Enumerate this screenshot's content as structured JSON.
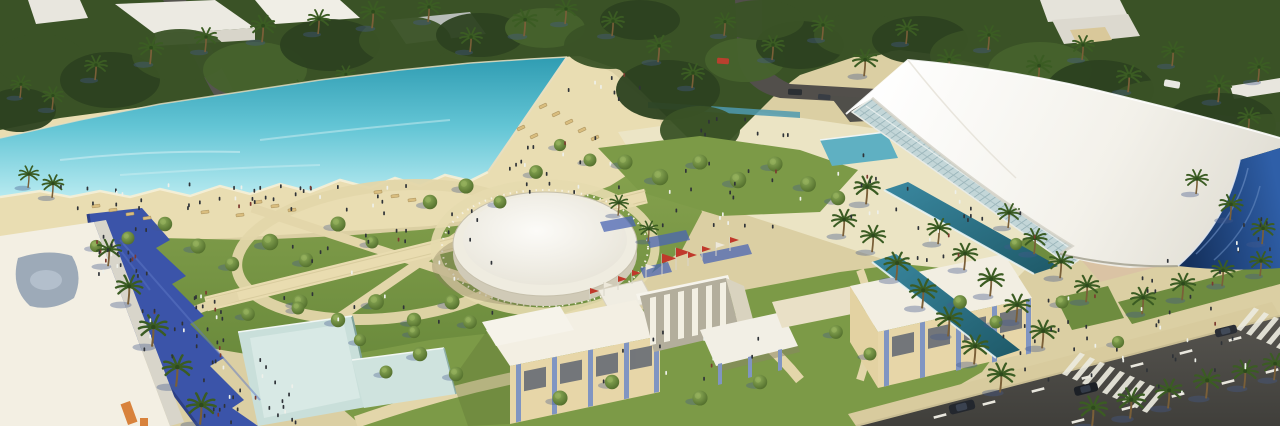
{
  "meta": {
    "type": "architectural-aerial-rendering",
    "description": "Aerial rendering of a coastal leisure park: turquoise lagoon pool with beach, landscaped gardens with paths, circular white pavilion, cream entrance buildings with red flags, sweeping white tensile canopy with glass facade and navy glass sail, palm-lined plazas, reflecting pools, blue shaded promenade and perimeter roads with crosswalks and cars.",
    "width": 1280,
    "height": 426
  },
  "palette": {
    "sand_base": "#dbcfa3",
    "beach": "#e9ddb2",
    "plaza": "#ece5c8",
    "sidewalk": "#d8cb9e",
    "canopy_green": "#3a5226",
    "grass": "#7c9a47",
    "grass_dark": "#6e8c3f",
    "water_deep": "#2f9cb2",
    "water_light": "#b7eaf0",
    "pool_pale": "#c9dfda",
    "pool_teal": "#2f7489",
    "promenade": "#3b54a9",
    "road": "#4c4b47",
    "road_top": "#524f4b",
    "canopy_white": "#f7f5ef",
    "glass": "#c3d6d8",
    "sail": "#1b3a6b",
    "bldg_cream": "#e7d6a8",
    "bldg_white": "#f3efe3",
    "bldg_grey": "#d8d5ca",
    "pilaster": "#8095c2",
    "flag_red": "#c0392b",
    "shadow_blue": "#44598c",
    "lounger": "#d9bd7e",
    "pink_shade": "#d8b9a6",
    "car_dark": "#23272e",
    "car_red": "#b8402e",
    "car_white": "#e8e7e2"
  },
  "scene": {
    "blob_tones": [
      "#3a5226",
      "#2c4120",
      "#46622c"
    ],
    "top_tree_blobs": [
      [
        40,
        60,
        45,
        26,
        0
      ],
      [
        110,
        80,
        50,
        28,
        1
      ],
      [
        180,
        55,
        48,
        26,
        0
      ],
      [
        255,
        70,
        52,
        28,
        2
      ],
      [
        330,
        45,
        50,
        26,
        1
      ],
      [
        405,
        40,
        46,
        24,
        0
      ],
      [
        480,
        35,
        44,
        22,
        1
      ],
      [
        545,
        28,
        40,
        20,
        2
      ],
      [
        610,
        45,
        46,
        24,
        0
      ],
      [
        668,
        90,
        52,
        30,
        1
      ],
      [
        700,
        130,
        40,
        24,
        0
      ],
      [
        745,
        60,
        40,
        22,
        2
      ],
      [
        800,
        45,
        44,
        24,
        1
      ],
      [
        860,
        35,
        46,
        22,
        0
      ],
      [
        920,
        40,
        48,
        24,
        1
      ],
      [
        980,
        55,
        50,
        26,
        0
      ],
      [
        1040,
        70,
        52,
        28,
        2
      ],
      [
        1100,
        90,
        54,
        30,
        1
      ],
      [
        1160,
        110,
        56,
        30,
        0
      ],
      [
        1220,
        125,
        56,
        32,
        1
      ],
      [
        1268,
        140,
        40,
        26,
        0
      ],
      [
        20,
        110,
        36,
        22,
        1
      ],
      [
        640,
        20,
        40,
        20,
        1
      ],
      [
        760,
        20,
        44,
        20,
        0
      ]
    ],
    "palms_back": [
      [
        95,
        78,
        1.0
      ],
      [
        150,
        62,
        1.1
      ],
      [
        205,
        50,
        1.0
      ],
      [
        262,
        40,
        1.1
      ],
      [
        318,
        32,
        1.0
      ],
      [
        372,
        26,
        1.1
      ],
      [
        428,
        20,
        1.0
      ],
      [
        300,
        100,
        0.9
      ],
      [
        345,
        86,
        0.9
      ],
      [
        470,
        50,
        1.0
      ],
      [
        524,
        34,
        1.1
      ],
      [
        565,
        22,
        1.0
      ],
      [
        612,
        34,
        1.0
      ],
      [
        658,
        60,
        1.1
      ],
      [
        692,
        86,
        1.0
      ],
      [
        724,
        34,
        0.95
      ],
      [
        772,
        58,
        1.0
      ],
      [
        822,
        38,
        1.0
      ],
      [
        864,
        74,
        1.1
      ],
      [
        906,
        42,
        1.0
      ],
      [
        948,
        74,
        1.1
      ],
      [
        988,
        48,
        1.0
      ],
      [
        1038,
        80,
        1.1
      ],
      [
        1082,
        58,
        1.0
      ],
      [
        1128,
        90,
        1.1
      ],
      [
        1172,
        64,
        1.0
      ],
      [
        1218,
        100,
        1.1
      ],
      [
        1258,
        80,
        1.0
      ],
      [
        1248,
        130,
        1.0
      ],
      [
        1110,
        120,
        1.0
      ],
      [
        1155,
        140,
        1.05
      ],
      [
        52,
        108,
        0.95
      ],
      [
        20,
        96,
        0.9
      ]
    ],
    "palms_front": [
      [
        866,
        202,
        1.15
      ],
      [
        843,
        234,
        1.1
      ],
      [
        938,
        242,
        1.05
      ],
      [
        964,
        268,
        1.1
      ],
      [
        990,
        294,
        1.15
      ],
      [
        1016,
        320,
        1.15
      ],
      [
        1042,
        346,
        1.15
      ],
      [
        1008,
        226,
        1.0
      ],
      [
        1034,
        252,
        1.05
      ],
      [
        1060,
        276,
        1.1
      ],
      [
        1086,
        300,
        1.1
      ],
      [
        872,
        250,
        1.1
      ],
      [
        896,
        278,
        1.15
      ],
      [
        922,
        306,
        1.2
      ],
      [
        948,
        334,
        1.2
      ],
      [
        974,
        362,
        1.2
      ],
      [
        1000,
        390,
        1.2
      ],
      [
        1142,
        312,
        1.1
      ],
      [
        1182,
        298,
        1.1
      ],
      [
        1222,
        284,
        1.05
      ],
      [
        1260,
        274,
        1.0
      ],
      [
        1092,
        424,
        1.25
      ],
      [
        1130,
        416,
        1.25
      ],
      [
        1168,
        406,
        1.2
      ],
      [
        1206,
        396,
        1.2
      ],
      [
        1244,
        386,
        1.15
      ],
      [
        1274,
        378,
        1.1
      ],
      [
        152,
        344,
        1.3
      ],
      [
        176,
        384,
        1.3
      ],
      [
        200,
        422,
        1.3
      ],
      [
        128,
        302,
        1.2
      ],
      [
        108,
        264,
        1.1
      ],
      [
        1196,
        192,
        1.0
      ],
      [
        1230,
        218,
        1.05
      ],
      [
        1262,
        242,
        1.05
      ],
      [
        618,
        214,
        0.85
      ],
      [
        648,
        240,
        0.85
      ],
      [
        52,
        196,
        0.95
      ],
      [
        28,
        186,
        0.9
      ]
    ],
    "trees": [
      [
        165,
        224,
        1.0
      ],
      [
        198,
        246,
        1.05
      ],
      [
        232,
        264,
        1.0
      ],
      [
        270,
        242,
        1.15
      ],
      [
        306,
        260,
        1.0
      ],
      [
        338,
        224,
        1.05
      ],
      [
        372,
        242,
        0.9
      ],
      [
        300,
        302,
        1.05
      ],
      [
        338,
        320,
        1.0
      ],
      [
        376,
        302,
        1.1
      ],
      [
        414,
        320,
        1.0
      ],
      [
        452,
        302,
        1.05
      ],
      [
        470,
        322,
        0.95
      ],
      [
        430,
        202,
        1.0
      ],
      [
        466,
        186,
        1.05
      ],
      [
        500,
        202,
        0.9
      ],
      [
        536,
        172,
        0.95
      ],
      [
        625,
        162,
        1.05
      ],
      [
        660,
        177,
        1.15
      ],
      [
        700,
        162,
        1.05
      ],
      [
        738,
        180,
        1.15
      ],
      [
        775,
        164,
        1.05
      ],
      [
        808,
        184,
        1.1
      ],
      [
        838,
        198,
        1.0
      ],
      [
        420,
        354,
        1.0
      ],
      [
        386,
        372,
        0.9
      ],
      [
        456,
        374,
        1.0
      ],
      [
        560,
        398,
        1.05
      ],
      [
        612,
        382,
        1.0
      ],
      [
        700,
        398,
        1.05
      ],
      [
        760,
        382,
        1.0
      ],
      [
        836,
        332,
        0.95
      ],
      [
        870,
        354,
        0.9
      ],
      [
        960,
        302,
        0.95
      ],
      [
        996,
        322,
        0.9
      ],
      [
        248,
        314,
        0.95
      ],
      [
        298,
        308,
        0.9
      ],
      [
        360,
        340,
        0.85
      ],
      [
        414,
        332,
        0.85
      ],
      [
        128,
        238,
        0.9
      ],
      [
        96,
        246,
        0.85
      ],
      [
        1016,
        244,
        0.85
      ],
      [
        1062,
        302,
        0.9
      ],
      [
        1118,
        342,
        0.85
      ],
      [
        590,
        160,
        0.9
      ],
      [
        560,
        145,
        0.85
      ]
    ],
    "loungers": [
      [
        96,
        206,
        -8
      ],
      [
        113,
        210,
        -8
      ],
      [
        130,
        214,
        -8
      ],
      [
        147,
        218,
        -8
      ],
      [
        258,
        202,
        -8
      ],
      [
        275,
        206,
        -8
      ],
      [
        292,
        210,
        -8
      ],
      [
        378,
        192,
        -8
      ],
      [
        395,
        196,
        -8
      ],
      [
        412,
        200,
        -8
      ],
      [
        543,
        106,
        -25
      ],
      [
        556,
        114,
        -25
      ],
      [
        569,
        122,
        -25
      ],
      [
        582,
        130,
        -25
      ],
      [
        595,
        138,
        -25
      ],
      [
        521,
        128,
        -25
      ],
      [
        534,
        136,
        -25
      ],
      [
        240,
        215,
        -8
      ],
      [
        205,
        212,
        -8
      ]
    ],
    "people_clusters": [
      [
        60,
        182,
        360,
        26,
        42
      ],
      [
        492,
        136,
        130,
        56,
        18
      ],
      [
        630,
        148,
        250,
        80,
        26
      ],
      [
        868,
        182,
        170,
        80,
        22
      ],
      [
        96,
        226,
        54,
        48,
        22
      ],
      [
        140,
        286,
        84,
        76,
        30
      ],
      [
        196,
        356,
        104,
        66,
        26
      ],
      [
        250,
        224,
        250,
        96,
        18
      ],
      [
        590,
        326,
        170,
        56,
        12
      ],
      [
        1028,
        244,
        210,
        100,
        26
      ],
      [
        990,
        322,
        200,
        56,
        12
      ],
      [
        1120,
        352,
        130,
        56,
        10
      ],
      [
        1230,
        216,
        44,
        44,
        8
      ],
      [
        360,
        200,
        120,
        40,
        10
      ],
      [
        700,
        110,
        90,
        24,
        8
      ],
      [
        560,
        70,
        80,
        30,
        8
      ]
    ],
    "flags": [
      [
        590,
        302,
        1,
        "r"
      ],
      [
        604,
        296,
        1,
        "w"
      ],
      [
        618,
        290,
        1,
        "r"
      ],
      [
        632,
        284,
        1,
        "r"
      ],
      [
        646,
        278,
        1,
        "w"
      ],
      [
        662,
        276,
        1.6,
        "r"
      ],
      [
        676,
        270,
        1.6,
        "r"
      ],
      [
        688,
        266,
        1,
        "r"
      ],
      [
        702,
        260,
        1,
        "r"
      ],
      [
        716,
        256,
        1,
        "w"
      ],
      [
        730,
        251,
        1,
        "r"
      ]
    ],
    "road_dashes": [
      [
        940,
        416
      ],
      [
        989,
        403
      ],
      [
        1038,
        390
      ],
      [
        1088,
        377
      ],
      [
        1137,
        365
      ],
      [
        1186,
        352
      ],
      [
        1235,
        339
      ],
      [
        1078,
        421
      ],
      [
        1128,
        408
      ],
      [
        1178,
        395
      ],
      [
        1228,
        382
      ],
      [
        1272,
        371
      ]
    ],
    "crosswalks": [
      {
        "x": 1062,
        "y": 374,
        "n": 9
      },
      {
        "x": 1236,
        "y": 329,
        "n": 5
      }
    ]
  }
}
